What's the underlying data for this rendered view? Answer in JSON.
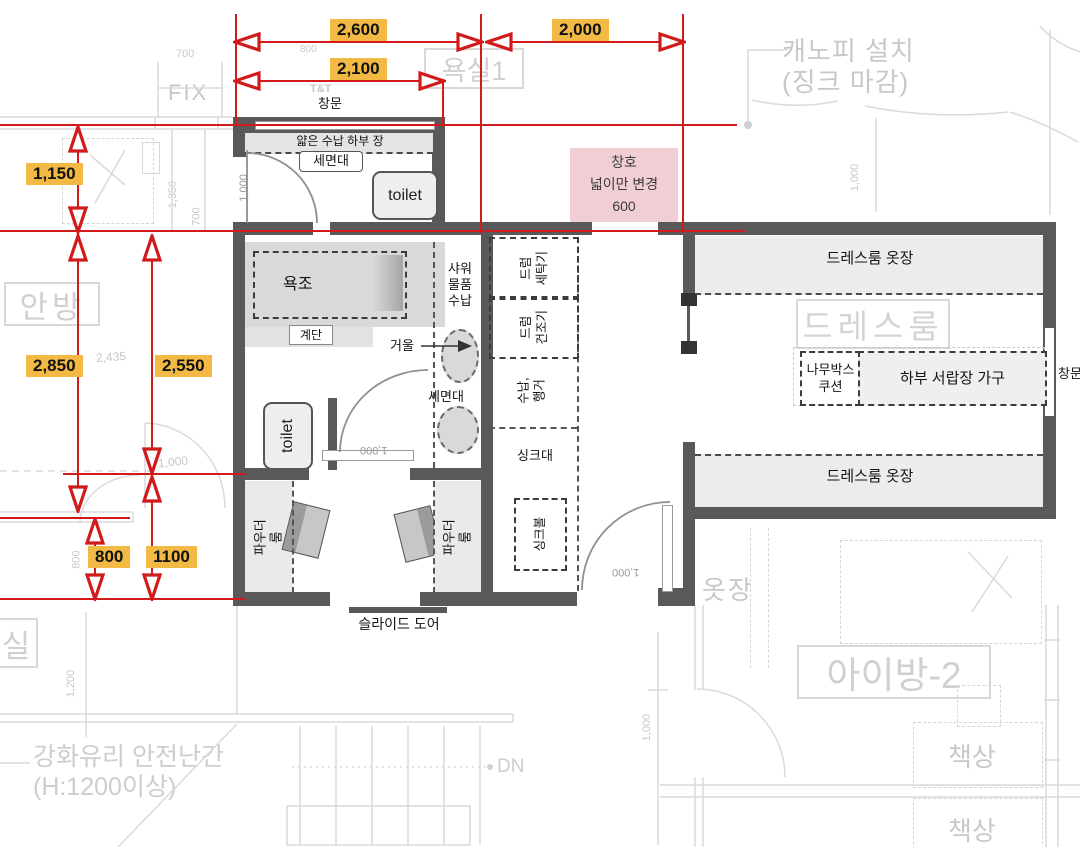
{
  "red_dims": {
    "w_total": "2,600",
    "w_right": "2,000",
    "w_window": "2,100",
    "h_top": "1,150",
    "h_left": "2,850",
    "h_inner": "2,550",
    "h_small": "800",
    "h_large": "1100"
  },
  "note": {
    "text": "창호\n넓이만 변경\n600"
  },
  "bath1": {
    "window": "창문",
    "cabinet": "얇은 수납 하부 장",
    "basin": "세면대",
    "toilet": "toilet",
    "door_dim": "1,000"
  },
  "bath2": {
    "tub": "욕조",
    "step": "계단",
    "shower": "샤워\n물품\n수납",
    "mirror": "거울",
    "basin": "세면대",
    "toilet": "toilet",
    "door_dim": "1,000"
  },
  "laundry": {
    "washer": "드럼\n세탁기",
    "dryer": "드럼\n건조기",
    "hanger": "수납,\n행거",
    "sink": "싱크대",
    "bowl": "싱크볼"
  },
  "powder": {
    "left": "파우더룸",
    "right": "파우더룸",
    "slide": "슬라이드 도어"
  },
  "dress": {
    "top": "드레스룸 옷장",
    "bottom": "드레스룸 옷장",
    "room": "드레스룸",
    "wood": "나무박스\n쿠션",
    "drawer": "하부 서랍장 가구",
    "window": "창문",
    "door_dim": "1,000"
  },
  "bg": {
    "canopy": "캐노피 설치\n(징크 마감)",
    "bath_old": "욕실1",
    "fix": "FIX",
    "tnt": "T&T",
    "d700": "700",
    "d800top": "800",
    "master": "안방",
    "d1350": "1,350",
    "d700b": "700",
    "d2435": "2,435",
    "d1000a": "1,000",
    "d800left": "800",
    "d1200": "1,200",
    "sil": "실",
    "rail": "강화유리 안전난간\n(H:1200이상)",
    "dn": "DN",
    "closet": "옷장",
    "kids": "아이방-2",
    "desk": "책상",
    "desk2": "책상",
    "d1000b": "1,000",
    "d1000c": "1,000"
  },
  "colors": {
    "wall": "#595959",
    "red": "#d11a1a",
    "dim_label_bg": "#f2ba45",
    "note_bg": "#f1ced3",
    "bg_line": "#d8d8d8"
  }
}
